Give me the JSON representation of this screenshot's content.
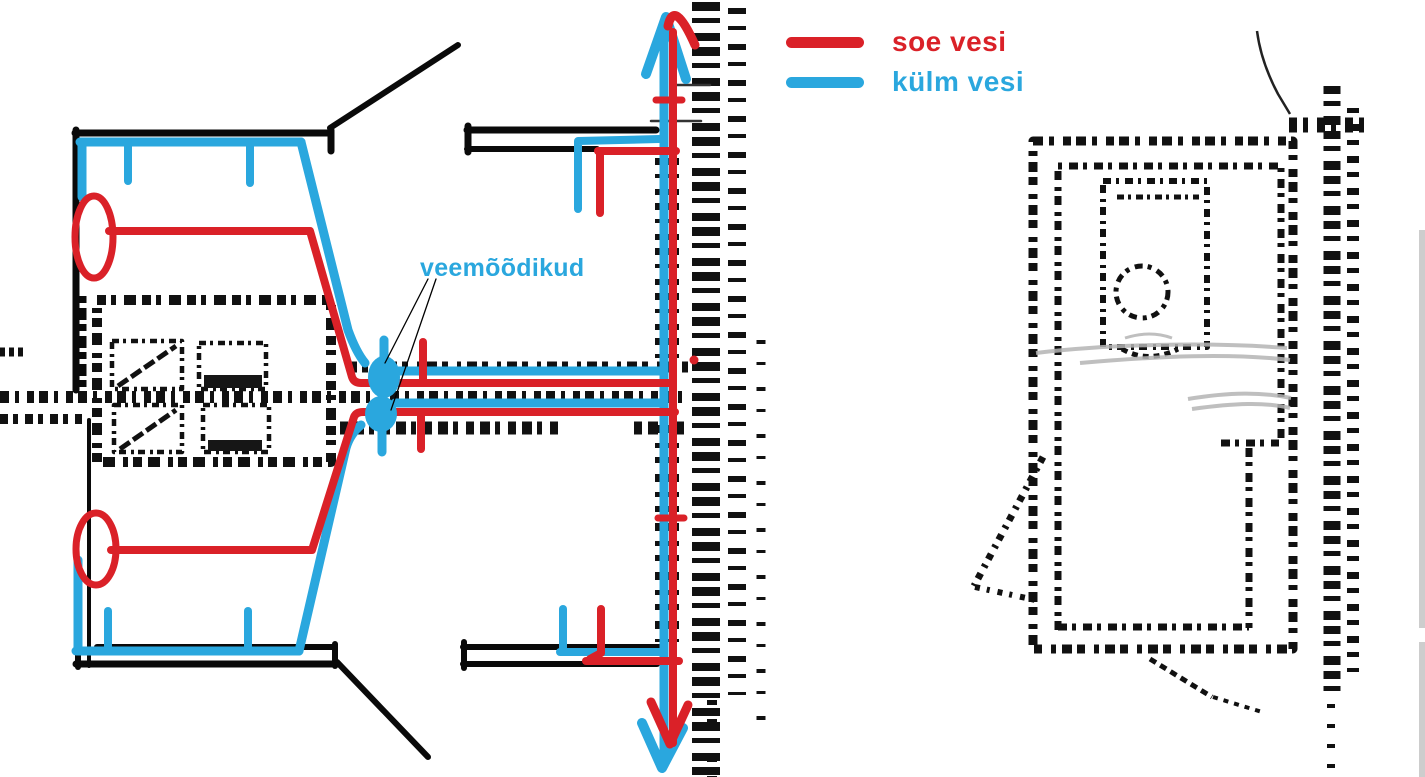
{
  "legend": {
    "items": [
      {
        "id": "hot-water",
        "label": "soe vesi",
        "color": "#da2128"
      },
      {
        "id": "cold-water",
        "label": "külm vesi",
        "color": "#2aa7de"
      }
    ]
  },
  "annotations": {
    "water_meters_label": "veemõõdikud",
    "water_meters_label_color": "#2aa7de"
  },
  "drawing": {
    "hot_color": "#da2128",
    "cold_color": "#2aa7de",
    "wall_color": "#0a0a0a",
    "pencil_color": "#b5b5b5",
    "right_edge_strip_color": "#cdcdcd"
  }
}
